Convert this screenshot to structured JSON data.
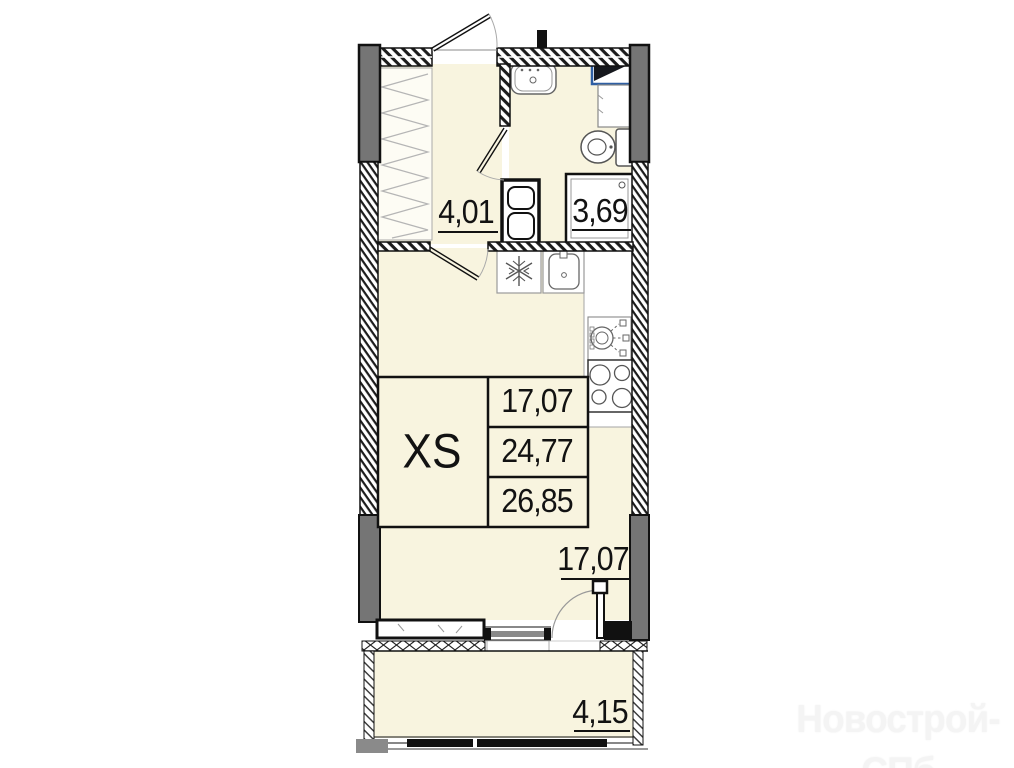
{
  "plan": {
    "type_label": "XS",
    "table_rows": [
      "17,07",
      "24,77",
      "26,85"
    ],
    "labels": {
      "hallway_area": "4,01",
      "bathroom_area": "3,69",
      "room_area": "17,07",
      "balcony_area": "4,15"
    },
    "colors": {
      "floor": "#f8f4df",
      "wall_gray": "#757575",
      "accent_blue": "#2f5fa3",
      "line": "#111111"
    }
  },
  "watermark": {
    "text": "Новострой-СПб"
  }
}
